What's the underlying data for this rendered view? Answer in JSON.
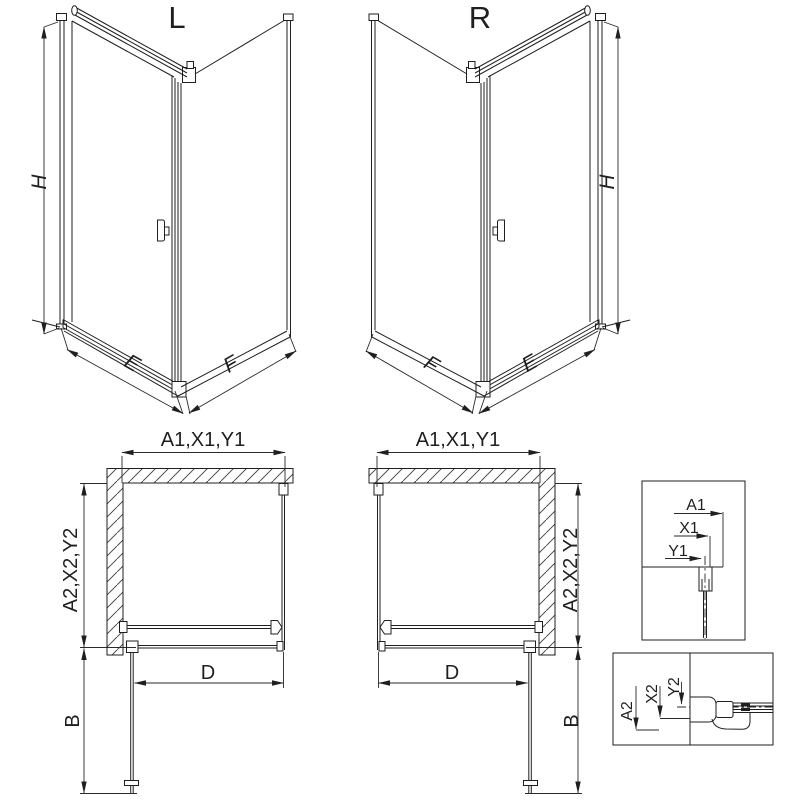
{
  "drawing": {
    "iso_left": {
      "title": "L",
      "height_label": "H",
      "front_width_label": "E",
      "side_width_label": "F"
    },
    "iso_right": {
      "title": "R",
      "height_label": "H",
      "front_width_label": "E",
      "side_width_label": "F"
    },
    "plan_left": {
      "top_dim": "A1,X1,Y1",
      "side_dim": "A2,X2,Y2",
      "entry_width": "D",
      "door_swing": "B"
    },
    "plan_right": {
      "top_dim": "A1,X1,Y1",
      "side_dim": "A2,X2,Y2",
      "entry_width": "D",
      "door_swing": "B"
    },
    "detail_top": {
      "a1": "A1",
      "x1": "X1",
      "y1": "Y1"
    },
    "detail_bottom": {
      "a2": "A2",
      "x2": "X2",
      "y2": "Y2"
    },
    "colors": {
      "line": "#1f1f1f",
      "background": "#ffffff"
    }
  }
}
